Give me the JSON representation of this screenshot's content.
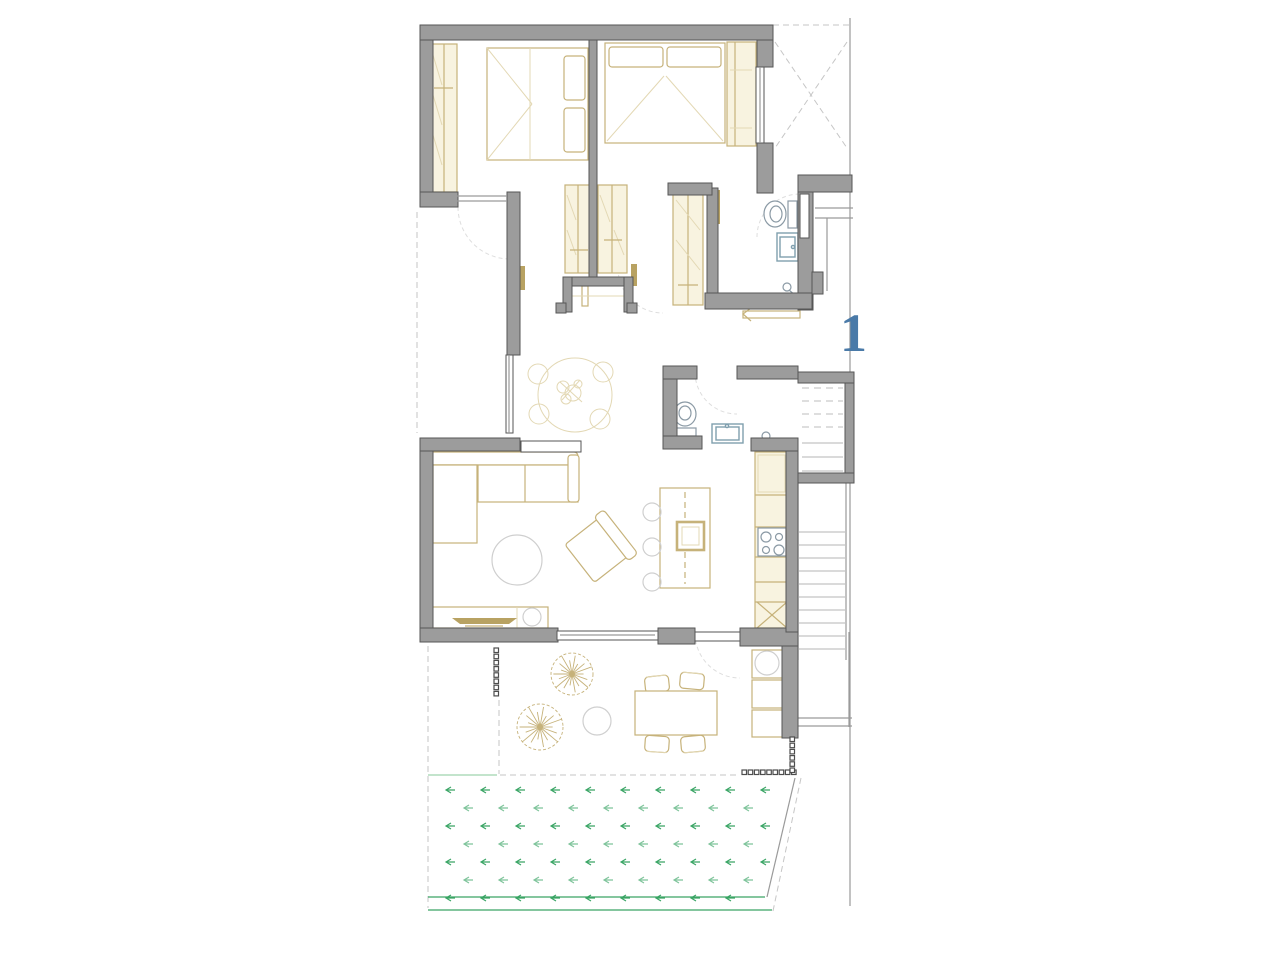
{
  "unit_label": {
    "text": "1"
  },
  "palette": {
    "bg": "#ffffff",
    "wall_fill": "#9c9c9c",
    "wall_stroke": "#565656",
    "furniture": "#c6b27a",
    "furniture_dark": "#b8a262",
    "furniture_lightfill": "#f8f3e0",
    "furniture_light2": "#e3d8b4",
    "line": "#9a9a9a",
    "dashed": "#c6c6c6",
    "arc": "#dedede",
    "fixture_blue": "#7f9fae",
    "green": "#3aa565",
    "green_light": "#9fd4ae",
    "accent": "#4a7aa8"
  },
  "plan": {
    "trees": [
      {
        "cx": 572,
        "cy": 674,
        "r": 21
      },
      {
        "cx": 540,
        "cy": 727,
        "r": 23
      }
    ],
    "garden": {
      "y_start": 790,
      "row_gap": 18,
      "rows": 7,
      "x_start_even": 446,
      "x_start_odd": 429,
      "col_gap": 35,
      "x_min": 432,
      "slant_x_top": 795,
      "slant_y_top": 778,
      "slant_x_bot": 767,
      "slant_y_bot": 897
    },
    "stairs": {
      "upper_dashed": {
        "x1": 802,
        "x2": 843,
        "y_start": 388,
        "gap": 13,
        "count": 4
      },
      "upper_solid": {
        "x1": 802,
        "x2": 843,
        "y_start": 443,
        "gap": 14,
        "count": 3
      },
      "lower": {
        "x1": 799,
        "x2": 845,
        "y_start": 532,
        "gap": 13,
        "count": 10
      }
    },
    "fences": [
      {
        "x": 494,
        "y": 648,
        "dx": 0,
        "dy": 6.2,
        "count": 8
      },
      {
        "x": 742,
        "y": 770,
        "dx": 6.2,
        "dy": 0,
        "count": 9
      },
      {
        "x": 790,
        "y": 737,
        "dx": 0,
        "dy": 6.2,
        "count": 6
      }
    ]
  }
}
